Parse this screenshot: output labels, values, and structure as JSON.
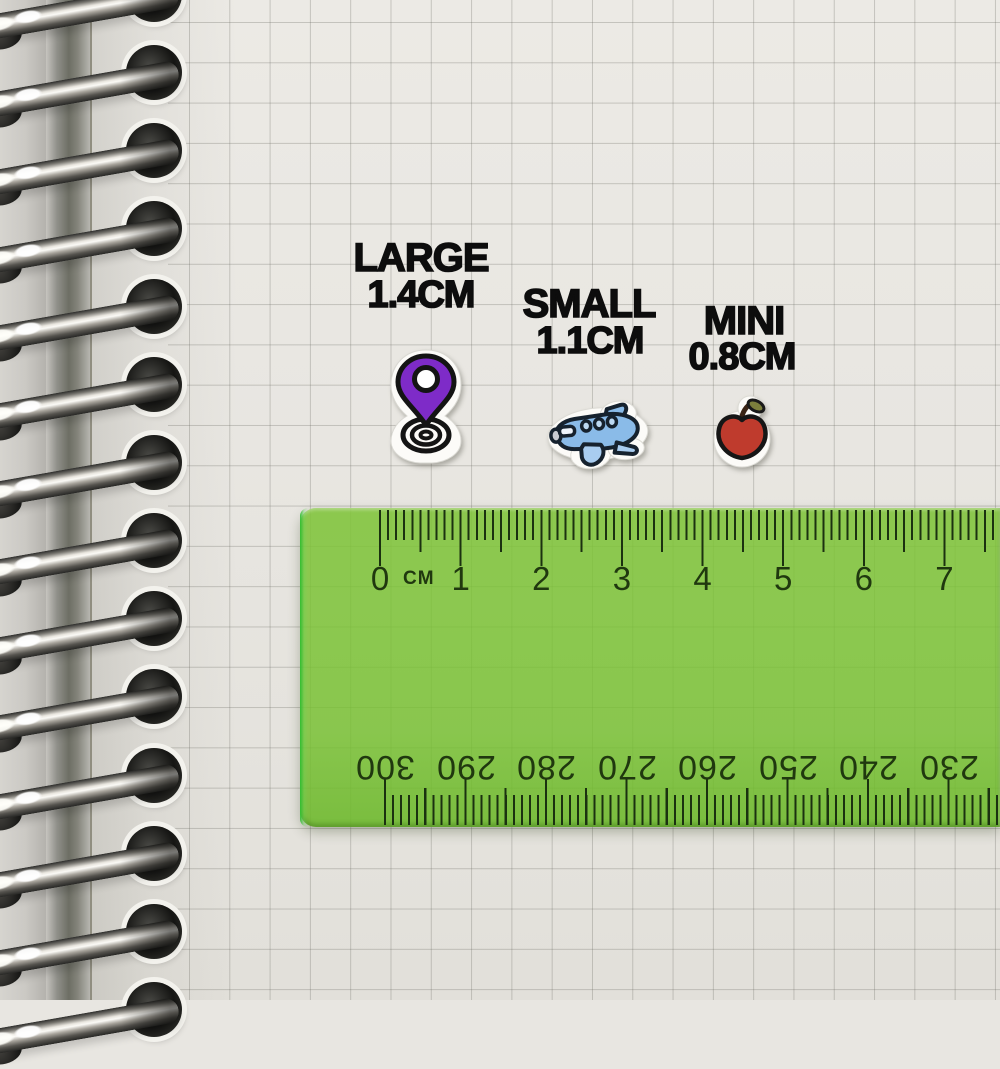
{
  "labels": {
    "large_name": "LARGE",
    "large_size": "1.4CM",
    "small_name": "SMALL",
    "small_size": "1.1CM",
    "mini_name": "MINI",
    "mini_size": "0.8CM"
  },
  "stickers": [
    {
      "icon": "location-pin-icon",
      "label": "LARGE",
      "size": "1.4CM",
      "fill_color": "#7e2bc8"
    },
    {
      "icon": "airplane-icon",
      "label": "SMALL",
      "size": "1.1CM",
      "fill_color": "#8abbe8"
    },
    {
      "icon": "apple-icon",
      "label": "MINI",
      "size": "0.8CM",
      "fill_color": "#bf3b2d"
    }
  ],
  "ruler": {
    "unit_label": "CM",
    "top_scale_numbers": [
      "0",
      "1",
      "2",
      "3",
      "4",
      "5",
      "6",
      "7"
    ],
    "bottom_scale_numbers": [
      "300",
      "290",
      "280",
      "270",
      "260",
      "250",
      "240",
      "230"
    ],
    "body_color": "#85c448",
    "tick_color": "#1b3110"
  },
  "notebook": {
    "ring_count": 14,
    "paper_color": "#e8e6e1",
    "grid_color": "#a9a8a0"
  }
}
